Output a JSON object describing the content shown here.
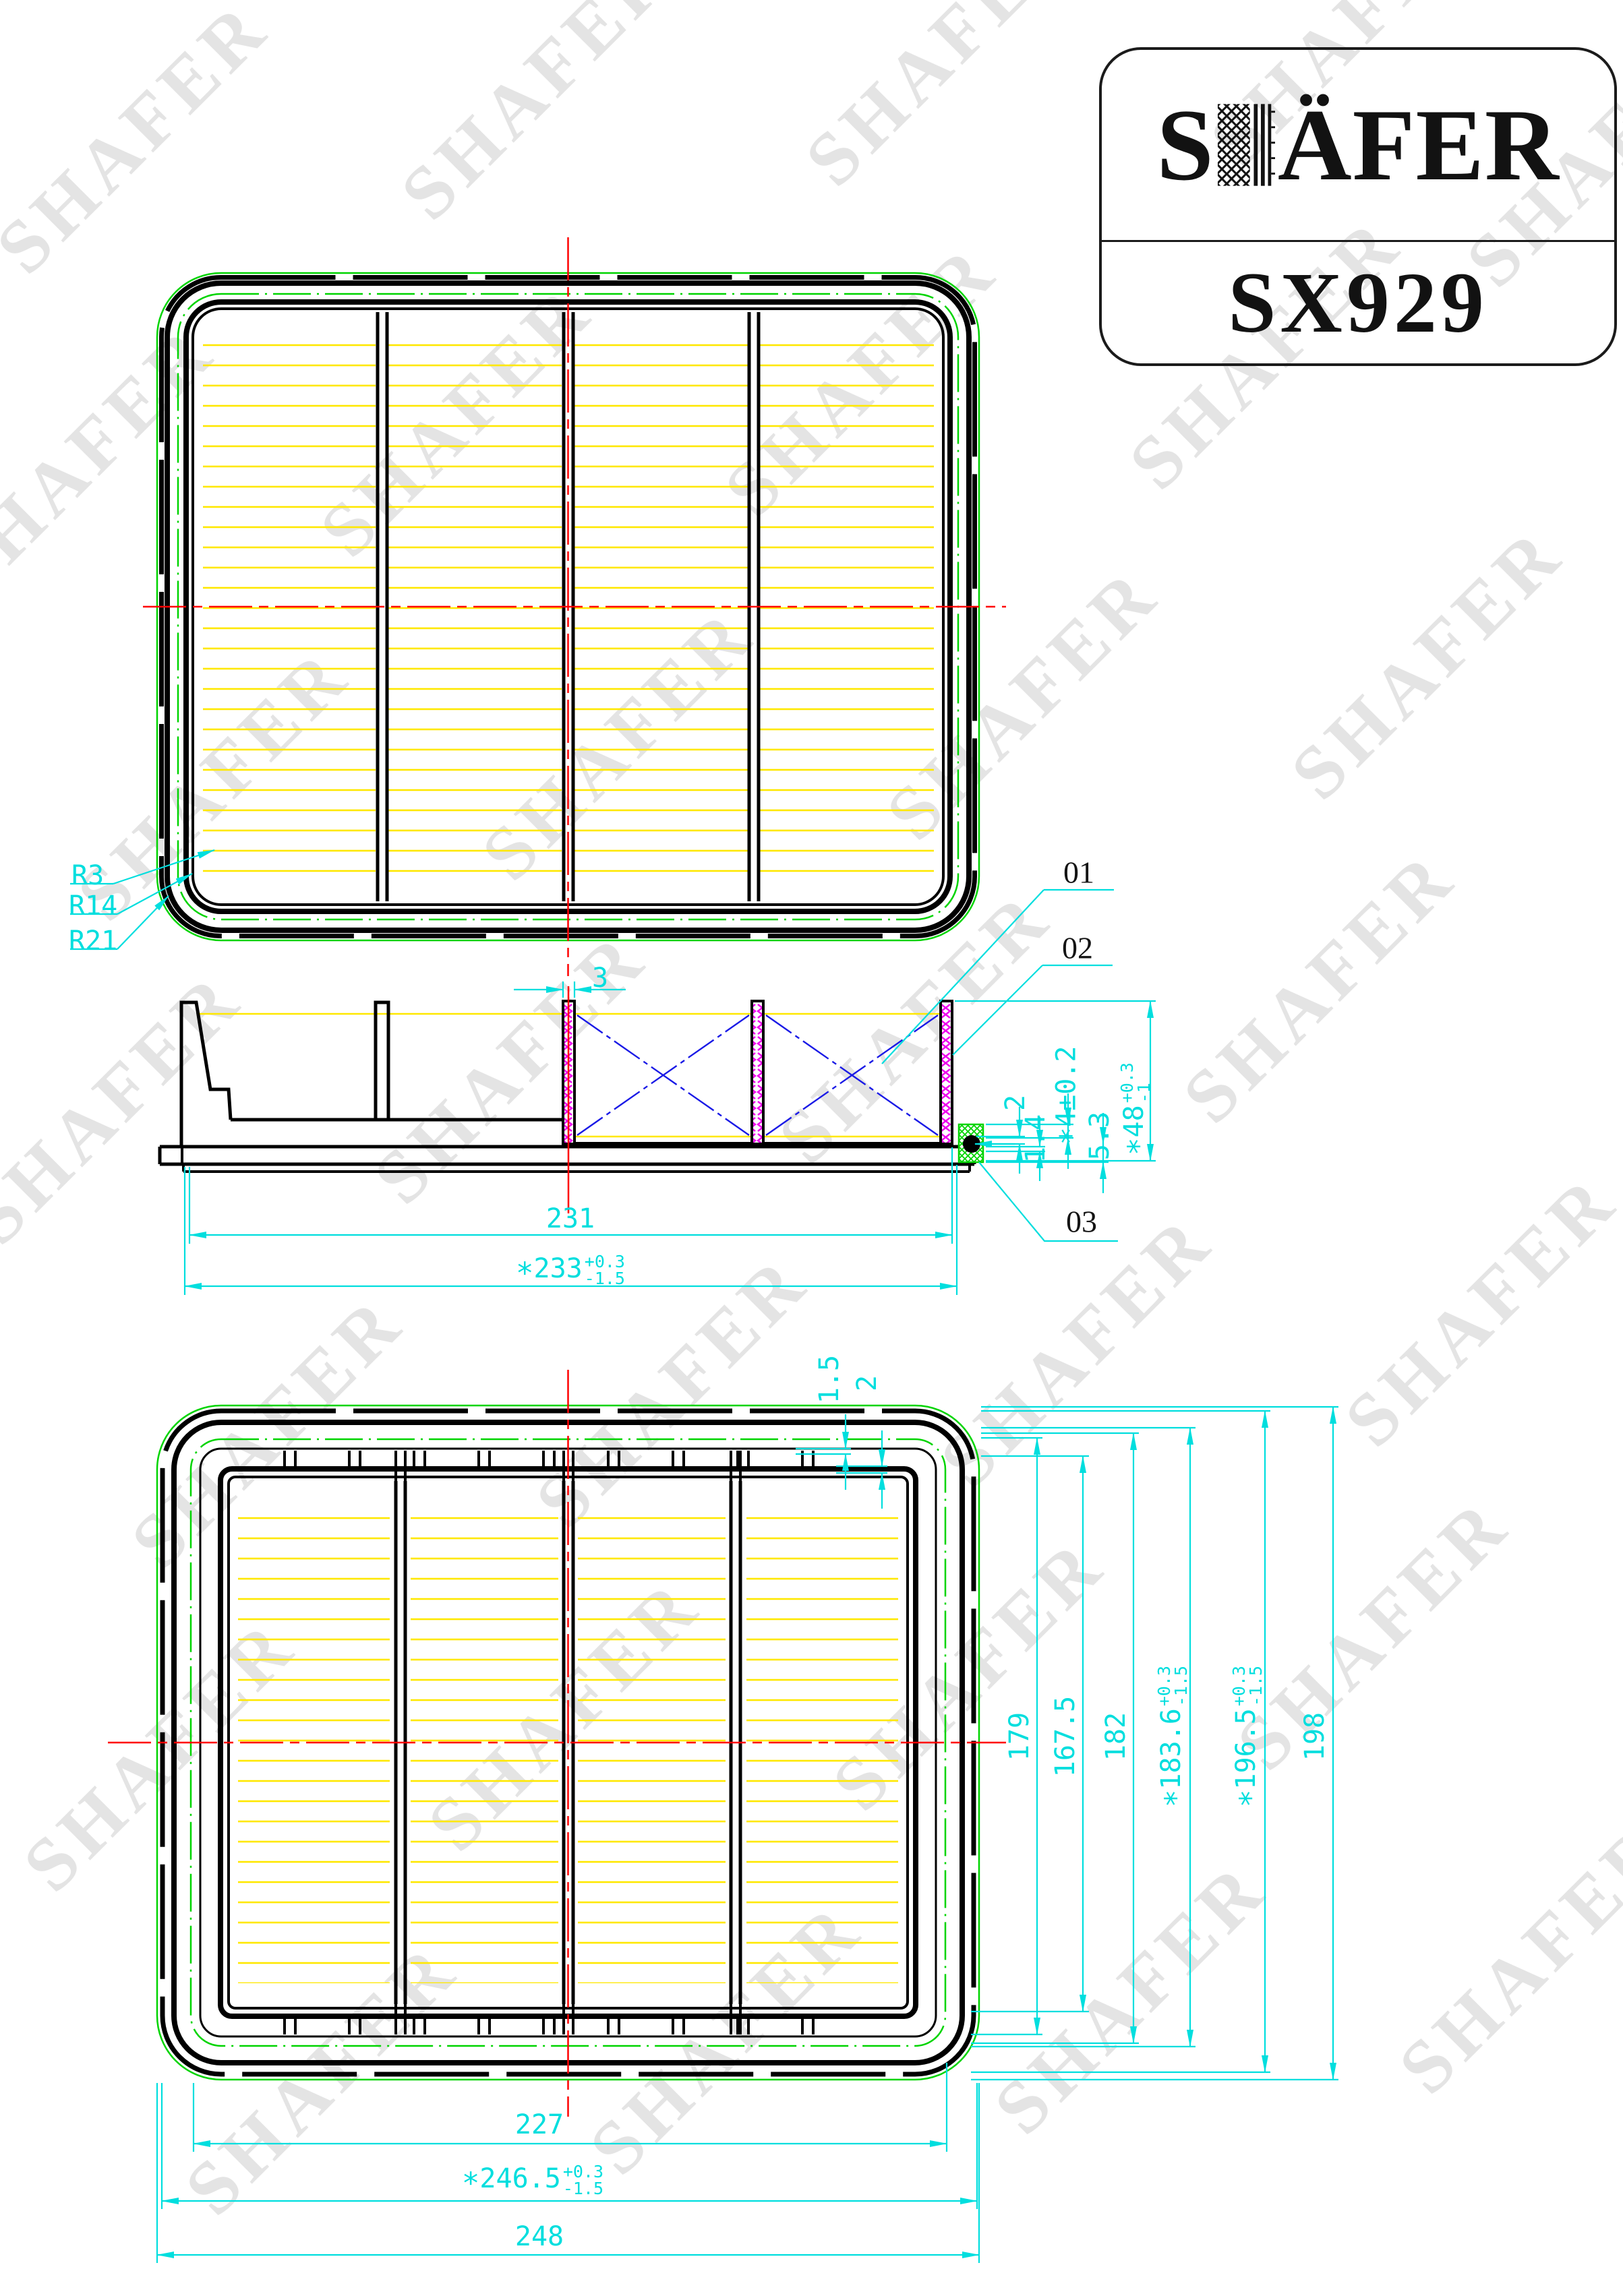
{
  "watermark": {
    "text": "SHAFER"
  },
  "logo": {
    "brand_prefix": "S",
    "brand_suffix": "ÄFER",
    "code": "SX929"
  },
  "top_view": {
    "radius_inner": "R3",
    "radius_mid": "R14",
    "radius_outer": "R21"
  },
  "side_view": {
    "callout_01": "01",
    "callout_02": "02",
    "callout_03": "03",
    "dim_pleat_frame_thickness": "3",
    "dim_inner_length": "231",
    "dim_media_length": {
      "star": "∗",
      "value": "233",
      "tol_plus": "+0.3",
      "tol_minus": "-1.5"
    },
    "dim_edge_gap": "2",
    "dim_lip": "1.4",
    "dim_seal_height": {
      "star": "∗",
      "value": "4±0.2"
    },
    "dim_seal_depth": "5.3",
    "dim_total_height": {
      "star": "∗",
      "value": "48",
      "tol_plus": "+0.3",
      "tol_minus": "-1"
    }
  },
  "bottom_view": {
    "dim_lip_1": "1.5",
    "dim_lip_2": "2",
    "dim_height_a": "179",
    "dim_height_b": "167.5",
    "dim_height_c": "182",
    "dim_height_seal": {
      "star": "∗",
      "value": "183.6",
      "tol_plus": "+0.3",
      "tol_minus": "-1.5"
    },
    "dim_height_outer": {
      "star": "∗",
      "value": "196.5",
      "tol_plus": "+0.3",
      "tol_minus": "-1.5"
    },
    "dim_height_total": "198",
    "dim_width_inner": "227",
    "dim_width_seal": {
      "star": "∗",
      "value": "246.5",
      "tol_plus": "+0.3",
      "tol_minus": "-1.5"
    },
    "dim_width_total": "248"
  },
  "colors": {
    "dimension": "#00dede",
    "outline": "#000000",
    "gasket_green": "#00d400",
    "pleat_yellow": "#ffe800",
    "media_magenta": "#ee00ee",
    "support_blue": "#1a1ae6",
    "centerline_red": "#ff0000",
    "watermark_gray": "#e4e4e4"
  }
}
